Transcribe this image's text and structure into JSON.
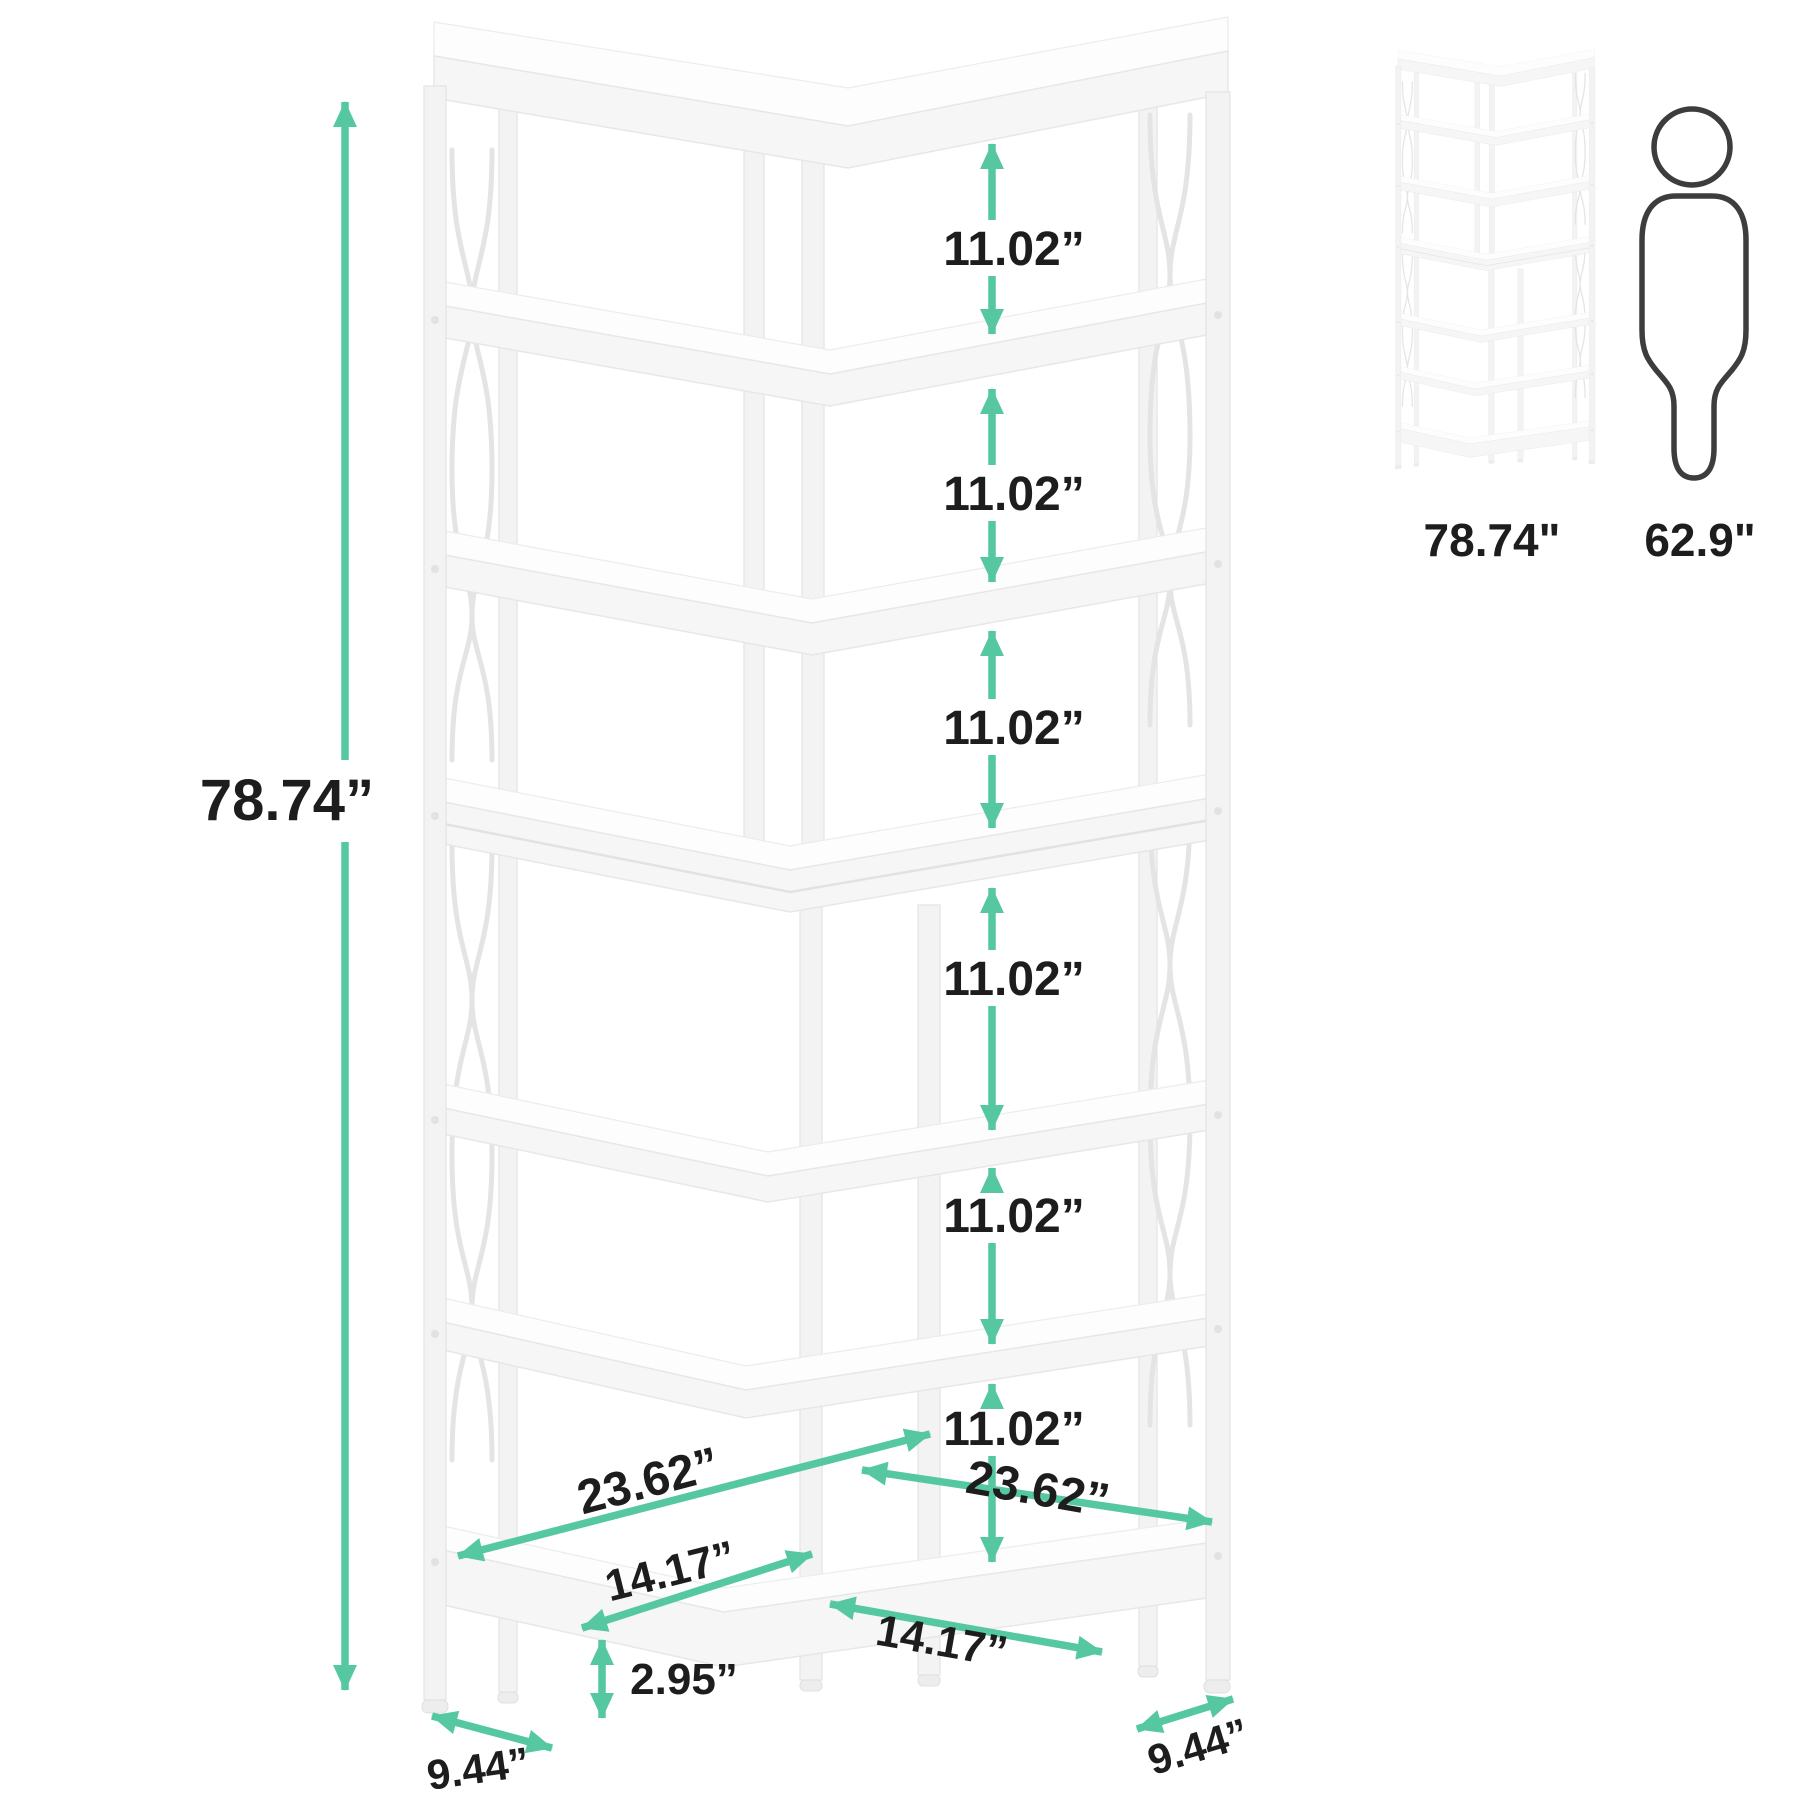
{
  "colors": {
    "accent": "#55c7a1",
    "label_text": "#1d1d1d",
    "shelf_white": "#f6f6f6",
    "outline_gray": "#e7e7e7",
    "person_outline": "#3d3d3d"
  },
  "main_diagram": {
    "product": "7-tier corner bookshelf",
    "height_label": "78.74”",
    "shelf_gaps": [
      "11.02”",
      "11.02”",
      "11.02”",
      "11.02”",
      "11.02”",
      "11.02”"
    ],
    "shelf_width_left": "23.62”",
    "shelf_width_right": "23.62”",
    "inner_depth_left": "14.17”",
    "inner_depth_right": "14.17”",
    "base_height": "2.95”",
    "side_depth_left": "9.44”",
    "side_depth_right": "9.44”"
  },
  "comparison": {
    "shelf_height_label": "78.74\"",
    "person_height_label": "62.9\""
  }
}
